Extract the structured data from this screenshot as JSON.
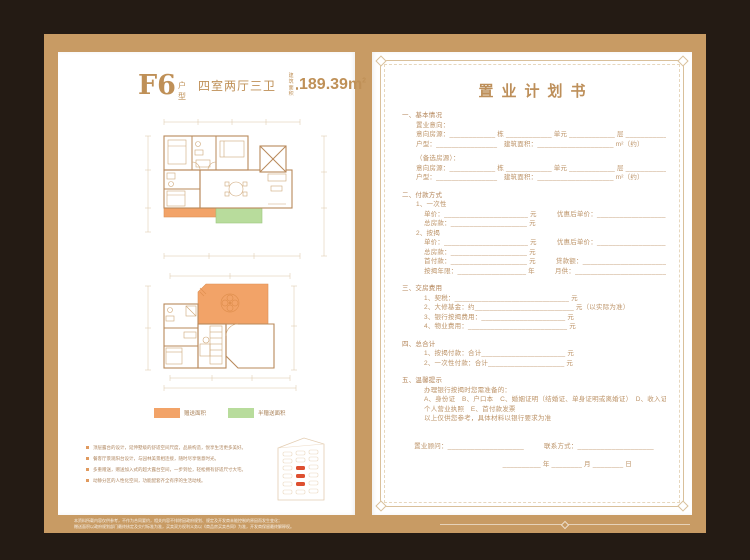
{
  "canvas": {
    "background_color": "#241b14",
    "frame_color": "#c89b64",
    "page_color": "#ffffff",
    "gift_area_color": "#f2a368",
    "half_gift_area_color": "#b8dc9c"
  },
  "left_page": {
    "header": {
      "type_code": "F6",
      "type_suffix": "户型",
      "rooms": "四室两厅三卫",
      "area_label_line1": "建筑",
      "area_label_line2": "面积",
      "area_value": "189.39m",
      "area_sup": "2"
    },
    "legend": {
      "gift": {
        "label": "赠送面积",
        "color": "#f2a368"
      },
      "half_gift": {
        "label": "半赠送面积",
        "color": "#b8dc9c"
      }
    },
    "features": [
      "顶层露台的设计，延伸墅级的舒适空间尺度，品质构造，悦享生活更多美好。",
      "餐客厅景观阳台设计，与园林美景相连接，随时尽享惬意时光。",
      "多重赠送，赠送加入式的超大露台空间，一步到位，轻松拥有舒适尺寸大宅。",
      "动静分区的人性化空间，功能配套齐全有序的生活动线。"
    ]
  },
  "right_page": {
    "title": "置业计划书",
    "rows": [
      {
        "cls": "sec",
        "text": "一、基本情况"
      },
      {
        "cls": "l1",
        "text": "置业意向："
      },
      {
        "cls": "l1",
        "text": "意向房源：____________ 栋 ____________ 单元 ____________ 层 ____________ 户"
      },
      {
        "cls": "l1",
        "text": "户型：________________　建筑面积：____________________ m²（约）"
      },
      {
        "cls": "gap",
        "text": ""
      },
      {
        "cls": "l1",
        "text": "（备选房源）："
      },
      {
        "cls": "l1",
        "text": "意向房源：____________ 栋 ____________ 单元 ____________ 层 ____________ 户"
      },
      {
        "cls": "l1",
        "text": "户型：________________　建筑面积：____________________ m²（约）"
      },
      {
        "cls": "gap",
        "text": ""
      },
      {
        "cls": "sec",
        "text": "二、付款方式"
      },
      {
        "cls": "l1",
        "text": "1、一次性"
      },
      {
        "cls": "l2",
        "text": "单价：______________________ 元　　　优惠后单价：__________________ 元"
      },
      {
        "cls": "l2",
        "text": "总房款：____________________ 元"
      },
      {
        "cls": "l1",
        "text": "2、按揭"
      },
      {
        "cls": "l2",
        "text": "单价：______________________ 元　　　优惠后单价：__________________ 元"
      },
      {
        "cls": "l2",
        "text": "总房款：____________________ 元"
      },
      {
        "cls": "l2",
        "text": "首付款：____________________ 元　　　贷款额：______________________ 万元"
      },
      {
        "cls": "l2",
        "text": "按揭年限：__________________ 年　　　月供：________________________ 元/月"
      },
      {
        "cls": "gap",
        "text": ""
      },
      {
        "cls": "sec",
        "text": "三、交房费用"
      },
      {
        "cls": "l2",
        "text": "1、契税：______________________________ 元"
      },
      {
        "cls": "l2",
        "text": "2、大修基金：约__________________________ 元（以实际为准）"
      },
      {
        "cls": "l2",
        "text": "3、银行按揭费用：______________________ 元"
      },
      {
        "cls": "l2",
        "text": "4、物业费用：__________________________ 元"
      },
      {
        "cls": "gap",
        "text": ""
      },
      {
        "cls": "sec",
        "text": "四、总合计"
      },
      {
        "cls": "l2",
        "text": "1、按揭付款：合计______________________ 元"
      },
      {
        "cls": "l2",
        "text": "2、一次性付款：合计____________________ 元"
      },
      {
        "cls": "gap",
        "text": ""
      },
      {
        "cls": "sec",
        "text": "五、温馨提示"
      },
      {
        "cls": "l2",
        "text": "办理银行按揭时您需准备的："
      },
      {
        "cls": "l2",
        "text": "A、身份证　B、户口本　C、婚姻证明（结婚证、单身证明或离婚证）　D、收入证明、银行流水或"
      },
      {
        "cls": "l2",
        "text": "个人营业执照　E、首付款发票"
      },
      {
        "cls": "l2",
        "text": "以上仅供您参考，具体材料以银行要求为准"
      },
      {
        "cls": "gap",
        "text": ""
      },
      {
        "cls": "sig1",
        "text": "置业顾问：____________________　　　联系方式：____________________"
      },
      {
        "cls": "sig2",
        "text": "__________ 年 ________ 月 ________ 日"
      }
    ]
  },
  "footer": {
    "disclaimer_line1": "本资料所载内容仅供参考，不作为合同要约，相关内容不排除因政府规划、规定及开发商未能控制的原因而发生变化；",
    "disclaimer_line2": "赠送面积以政府规划部门最终核定及交付标准为准，买卖双方权利义务以《商品房买卖合同》为准，开发商保留最终解释权。"
  }
}
